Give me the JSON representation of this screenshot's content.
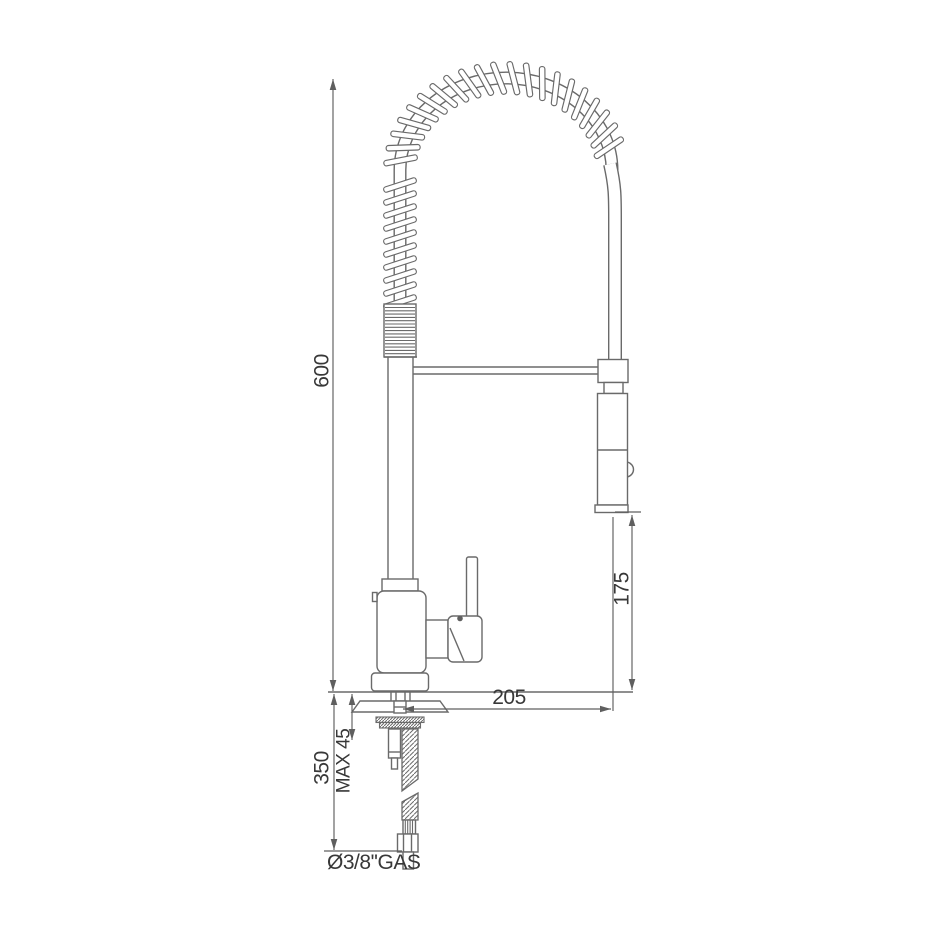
{
  "page": {
    "background": "#ffffff"
  },
  "colors": {
    "line": "#6a6a6a",
    "dimension": "#5f5f5f",
    "text": "#383838"
  },
  "diagram": {
    "name": "kitchen-mixer-with-spring-pulldown-spray-technical-drawing",
    "dimensions": [
      {
        "name": "overall-height",
        "label": "600"
      },
      {
        "name": "under-deck-length",
        "label": "350"
      },
      {
        "name": "max-deck-thickness",
        "label": "MAX 45"
      },
      {
        "name": "spout-reach",
        "label": "205"
      },
      {
        "name": "spray-outlet-height",
        "label": "175"
      },
      {
        "name": "supply-connection",
        "label": "Ø3/8''GAS"
      }
    ]
  }
}
